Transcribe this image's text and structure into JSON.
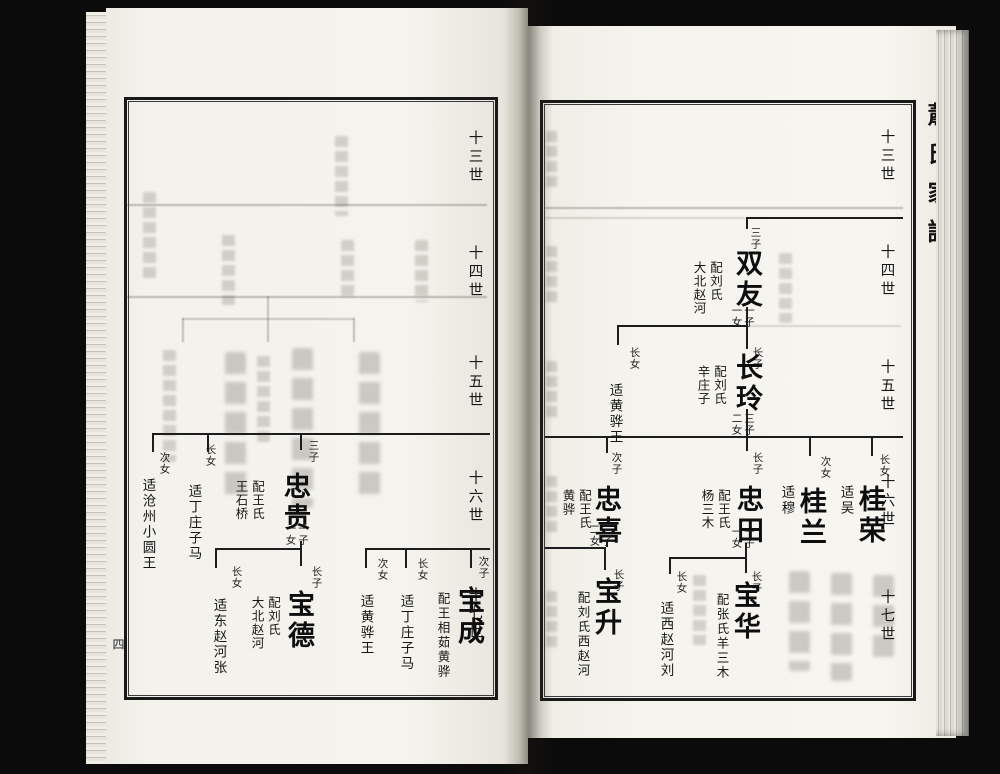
{
  "book": {
    "spine_title": "蕭氏家譜",
    "page_number": "四"
  },
  "generations": {
    "g13": "十三世",
    "g14": "十四世",
    "g15": "十五世",
    "g16": "十六世",
    "g17": "十七世"
  },
  "right_page": {
    "shuangyou": {
      "order": "三子",
      "name": "双友",
      "spouse": "配刘氏",
      "place": "大北赵河",
      "sons": "一子",
      "daughters": "一女"
    },
    "changling": {
      "order": "长子",
      "name": "长玲",
      "spouse": "配刘氏",
      "place": "辛庄子",
      "sons": "三子",
      "daughters": "二女"
    },
    "daughter_g15": {
      "order": "长女",
      "married": "适黄骅王"
    },
    "guirong": {
      "order": "长女",
      "name": "桂荣",
      "married": "适吴"
    },
    "guilan": {
      "order": "次女",
      "name": "桂兰",
      "married": "适穆"
    },
    "zhongtian": {
      "order": "长子",
      "name": "忠田",
      "spouse": "配王氏",
      "place": "杨三木",
      "sons": "一子",
      "daughters": "一女"
    },
    "zhongxi": {
      "order": "次子",
      "name": "忠喜",
      "spouse": "配王氏",
      "place": "黄骅",
      "sons": "二子",
      "daughters": "二女"
    },
    "baohua": {
      "order": "长子",
      "name": "宝华",
      "spouse": "配张氏羊三木"
    },
    "daughter_g17": {
      "order": "长女",
      "married": "适西赵河刘"
    },
    "baosheng": {
      "order": "长子",
      "name": "宝升",
      "spouse": "配刘氏西赵河"
    }
  },
  "left_page": {
    "zhonggui": {
      "order": "三子",
      "name": "忠贵",
      "spouse": "配王氏",
      "place": "王石桥",
      "sons": "一子",
      "daughters": "一女"
    },
    "daughter_g16_eldest": {
      "order": "长女",
      "married": "适丁庄子马"
    },
    "daughter_g16_second": {
      "order": "次女",
      "married": "适沧州小圆王"
    },
    "baode": {
      "order": "长子",
      "name": "宝德",
      "spouse": "配刘氏",
      "place": "大北赵河"
    },
    "daughter_g17_eldest": {
      "order": "长女",
      "married": "适东赵河张"
    },
    "baocheng": {
      "order": "次子",
      "name": "宝成",
      "spouse": "配王相茹黄骅"
    },
    "daughter_g17_dingzhuang": {
      "order": "长女",
      "married": "适丁庄子马"
    },
    "daughter_g17_huanghua": {
      "order": "次女",
      "married": "适黄骅王"
    }
  }
}
